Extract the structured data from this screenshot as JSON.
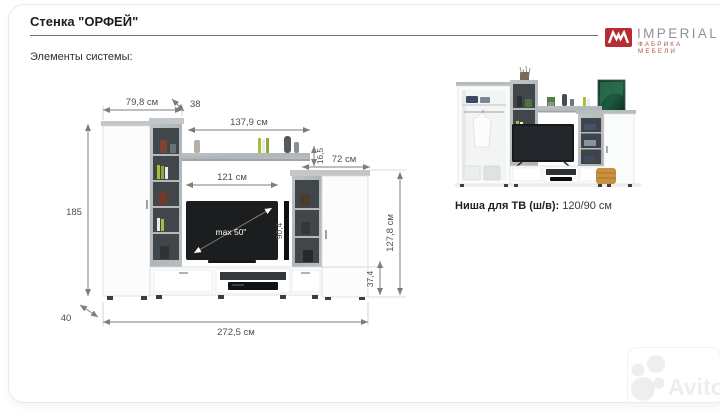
{
  "header": {
    "title": "Стенка \"ОРФЕЙ\"",
    "elements_label": "Элементы системы:"
  },
  "brand": {
    "name": "IMPERIAL",
    "tagline": "ФАБРИКА МЕБЕЛИ",
    "mark_icon": "imperial-monogram",
    "red": "#b52c32",
    "gray": "#8f9296"
  },
  "diagram": {
    "dims": {
      "left_width": "79,8 см",
      "depth_top": "38",
      "shelf_width": "137,9 см",
      "shelf_thickness": "16,5",
      "right_width": "72 см",
      "niche_width": "121 см",
      "total_height": "185",
      "niche_height": "90,4",
      "right_height": "127,8 см",
      "base_height": "37,4",
      "depth_bottom": "40",
      "total_width": "272,5 см"
    },
    "tv_label": "max 50\"",
    "colors": {
      "concrete": "#b4b9bc",
      "interior_dark": "#41464b",
      "white": "#fcfcfc",
      "dim_line": "#7d7d7d"
    }
  },
  "photo_caption": {
    "label": "Ниша для ТВ (ш/в):",
    "value": "120/90 см"
  },
  "watermark": {
    "text": "Avito"
  }
}
